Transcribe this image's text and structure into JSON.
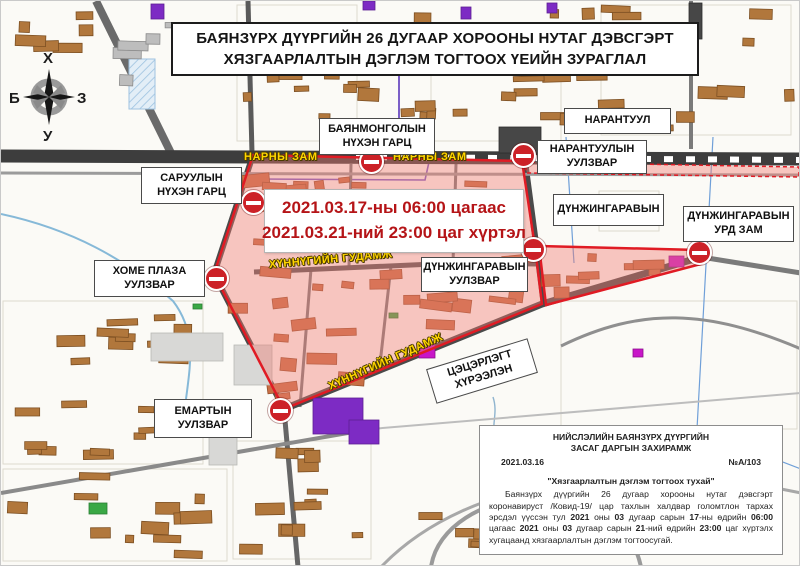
{
  "title": {
    "line1": "БАЯНЗҮРХ ДҮҮРГИЙН 26 ДУГААР ХОРООНЫ НУТАГ ДЭВСГЭРТ",
    "line2": "ХЯЗГААРЛАЛТЫН ДЭГЛЭМ ТОГТООХ ҮЕИЙН ЗУРАГЛАЛ"
  },
  "compass": {
    "north": "Х",
    "south": "У",
    "west": "Б",
    "east": "З"
  },
  "banner": {
    "line1": "2021.03.17-ны 06:00 цагаас",
    "line2": "2021.03.21-ний 23:00 цаг хүртэл"
  },
  "labels": [
    {
      "key": "bayanmongol-underpass",
      "text": "БАЯНМОНГОЛЫН\nНҮХЭН ГАРЦ"
    },
    {
      "key": "narantuul",
      "text": "НАРАНТУУЛ"
    },
    {
      "key": "saruul-underpass",
      "text": "САРУУЛЫН\nНҮХЭН ГАРЦ"
    },
    {
      "key": "narantuul-junction",
      "text": "НАРАНТУУЛЫН\nУУЛЗВАР"
    },
    {
      "key": "dunjingarav",
      "text": "ДҮНЖИНГАРАВЫН"
    },
    {
      "key": "dunjingarav-south-road",
      "text": "ДҮНЖИНГАРАВЫН\nУРД ЗАМ"
    },
    {
      "key": "home-plaza-junction",
      "text": "ХОМЕ ПЛАЗА\nУУЛЗВАР"
    },
    {
      "key": "dunjingarav-junction",
      "text": "ДҮНЖИНГАРАВЫН\nУУЛЗВАР"
    },
    {
      "key": "emart-junction",
      "text": "ЕМАРТЫН\nУУЛЗВАР"
    },
    {
      "key": "park",
      "text": "ЦЭЦЭРЛЭГТ\nХҮРЭЭЛЭН"
    }
  ],
  "street_labels": [
    {
      "text": "НАРНЫ ЗАМ"
    },
    {
      "text": "НАРНЫ ЗАМ"
    },
    {
      "text": "ХҮННҮГИЙН ГУДАМЖ"
    },
    {
      "text": "ХҮННҮГИЙН ГУДАМЖ"
    }
  ],
  "decree": {
    "header1": "НИЙСЛЭЛИЙН БАЯНЗҮРХ ДҮҮРГИЙН",
    "header2": "ЗАСАГ ДАРГЫН ЗАХИРАМЖ",
    "date": "2021.03.16",
    "number": "№А/103",
    "subject": "\"Хязгаарлалтын дэглэм тогтоох тухай\"",
    "body_segments": [
      {
        "t": "Баянзүрх дүүргийн 26 дугаар хорооны нутаг дэвсгэрт коронавируст /Ковид-19/ цар тахлын халдвар голомтлон тархах эрсдэл үүссэн тул ",
        "b": false
      },
      {
        "t": "2021",
        "b": true
      },
      {
        "t": " оны ",
        "b": false
      },
      {
        "t": "03",
        "b": true
      },
      {
        "t": " дугаар сарын ",
        "b": false
      },
      {
        "t": "17",
        "b": true
      },
      {
        "t": "-ны өдрийн ",
        "b": false
      },
      {
        "t": "06:00",
        "b": true
      },
      {
        "t": " цагаас ",
        "b": false
      },
      {
        "t": "2021",
        "b": true
      },
      {
        "t": " оны ",
        "b": false
      },
      {
        "t": "03",
        "b": true
      },
      {
        "t": " дугаар сарын ",
        "b": false
      },
      {
        "t": "21",
        "b": true
      },
      {
        "t": "-ний өдрийн ",
        "b": false
      },
      {
        "t": "23:00",
        "b": true
      },
      {
        "t": " цаг хүртэлх хугацаанд хязгаарлалтын дэглэм тогтоосугай.",
        "b": false
      }
    ]
  },
  "colors": {
    "zone_fill": "rgba(240,125,115,0.42)",
    "zone_border": "#e01b24",
    "no_entry": "#cc2127",
    "street_label": "#ffd500",
    "banner_text": "#b51417"
  }
}
